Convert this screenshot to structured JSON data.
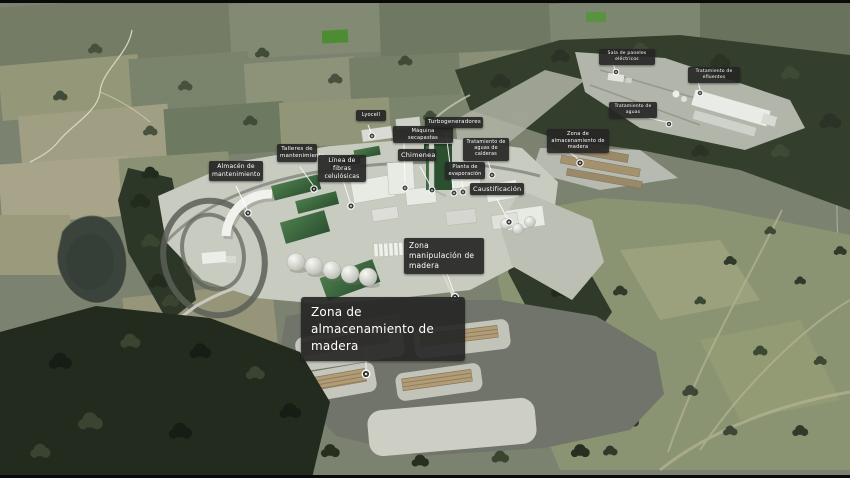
{
  "labels": [
    {
      "id": "almacen-mantenimiento",
      "text": "Almacén de mantenimiento"
    },
    {
      "id": "talleres-mantenimiento",
      "text": "Talleres de mantenimiento"
    },
    {
      "id": "linea-fibras-celulosicas",
      "text": "Línea de fibras celulósicas"
    },
    {
      "id": "lyocell",
      "text": "Lyocell"
    },
    {
      "id": "maquina-secapastas",
      "text": "Máquina secapastas"
    },
    {
      "id": "chimenea",
      "text": "Chimenea"
    },
    {
      "id": "turbogeneradores",
      "text": "Turbogeneradores"
    },
    {
      "id": "tratamiento-aguas-calderas",
      "text": "Tratamiento de aguas de calderas"
    },
    {
      "id": "planta-evaporacion",
      "text": "Planta de evaporación"
    },
    {
      "id": "caustificacion",
      "text": "Caustificación"
    },
    {
      "id": "zona-almacenamiento-madera-norte",
      "text": "Zona de almacenamiento de madera"
    },
    {
      "id": "sala-paneles-electricos",
      "text": "Sala de paneles eléctricos"
    },
    {
      "id": "tratamiento-efluentes",
      "text": "Tratamiento de efluentes"
    },
    {
      "id": "tratamiento-aguas",
      "text": "Tratamiento de aguas"
    },
    {
      "id": "zona-manipulacion-madera",
      "text": "Zona manipulación de madera"
    },
    {
      "id": "zona-almacenamiento-madera-sur",
      "text": "Zona de almacenamiento de madera"
    }
  ],
  "colors": {
    "callout_background": "#262626",
    "callout_text": "#ffffff",
    "leader_line": "#ffffff",
    "marker_ring": "#ffffff",
    "forest_dark": "#2d3727",
    "moorland": "#8b9472",
    "plant_platform": "#c8cbc0",
    "warehouse_green": "#2b5130",
    "wood_pile": "#b19c77"
  }
}
